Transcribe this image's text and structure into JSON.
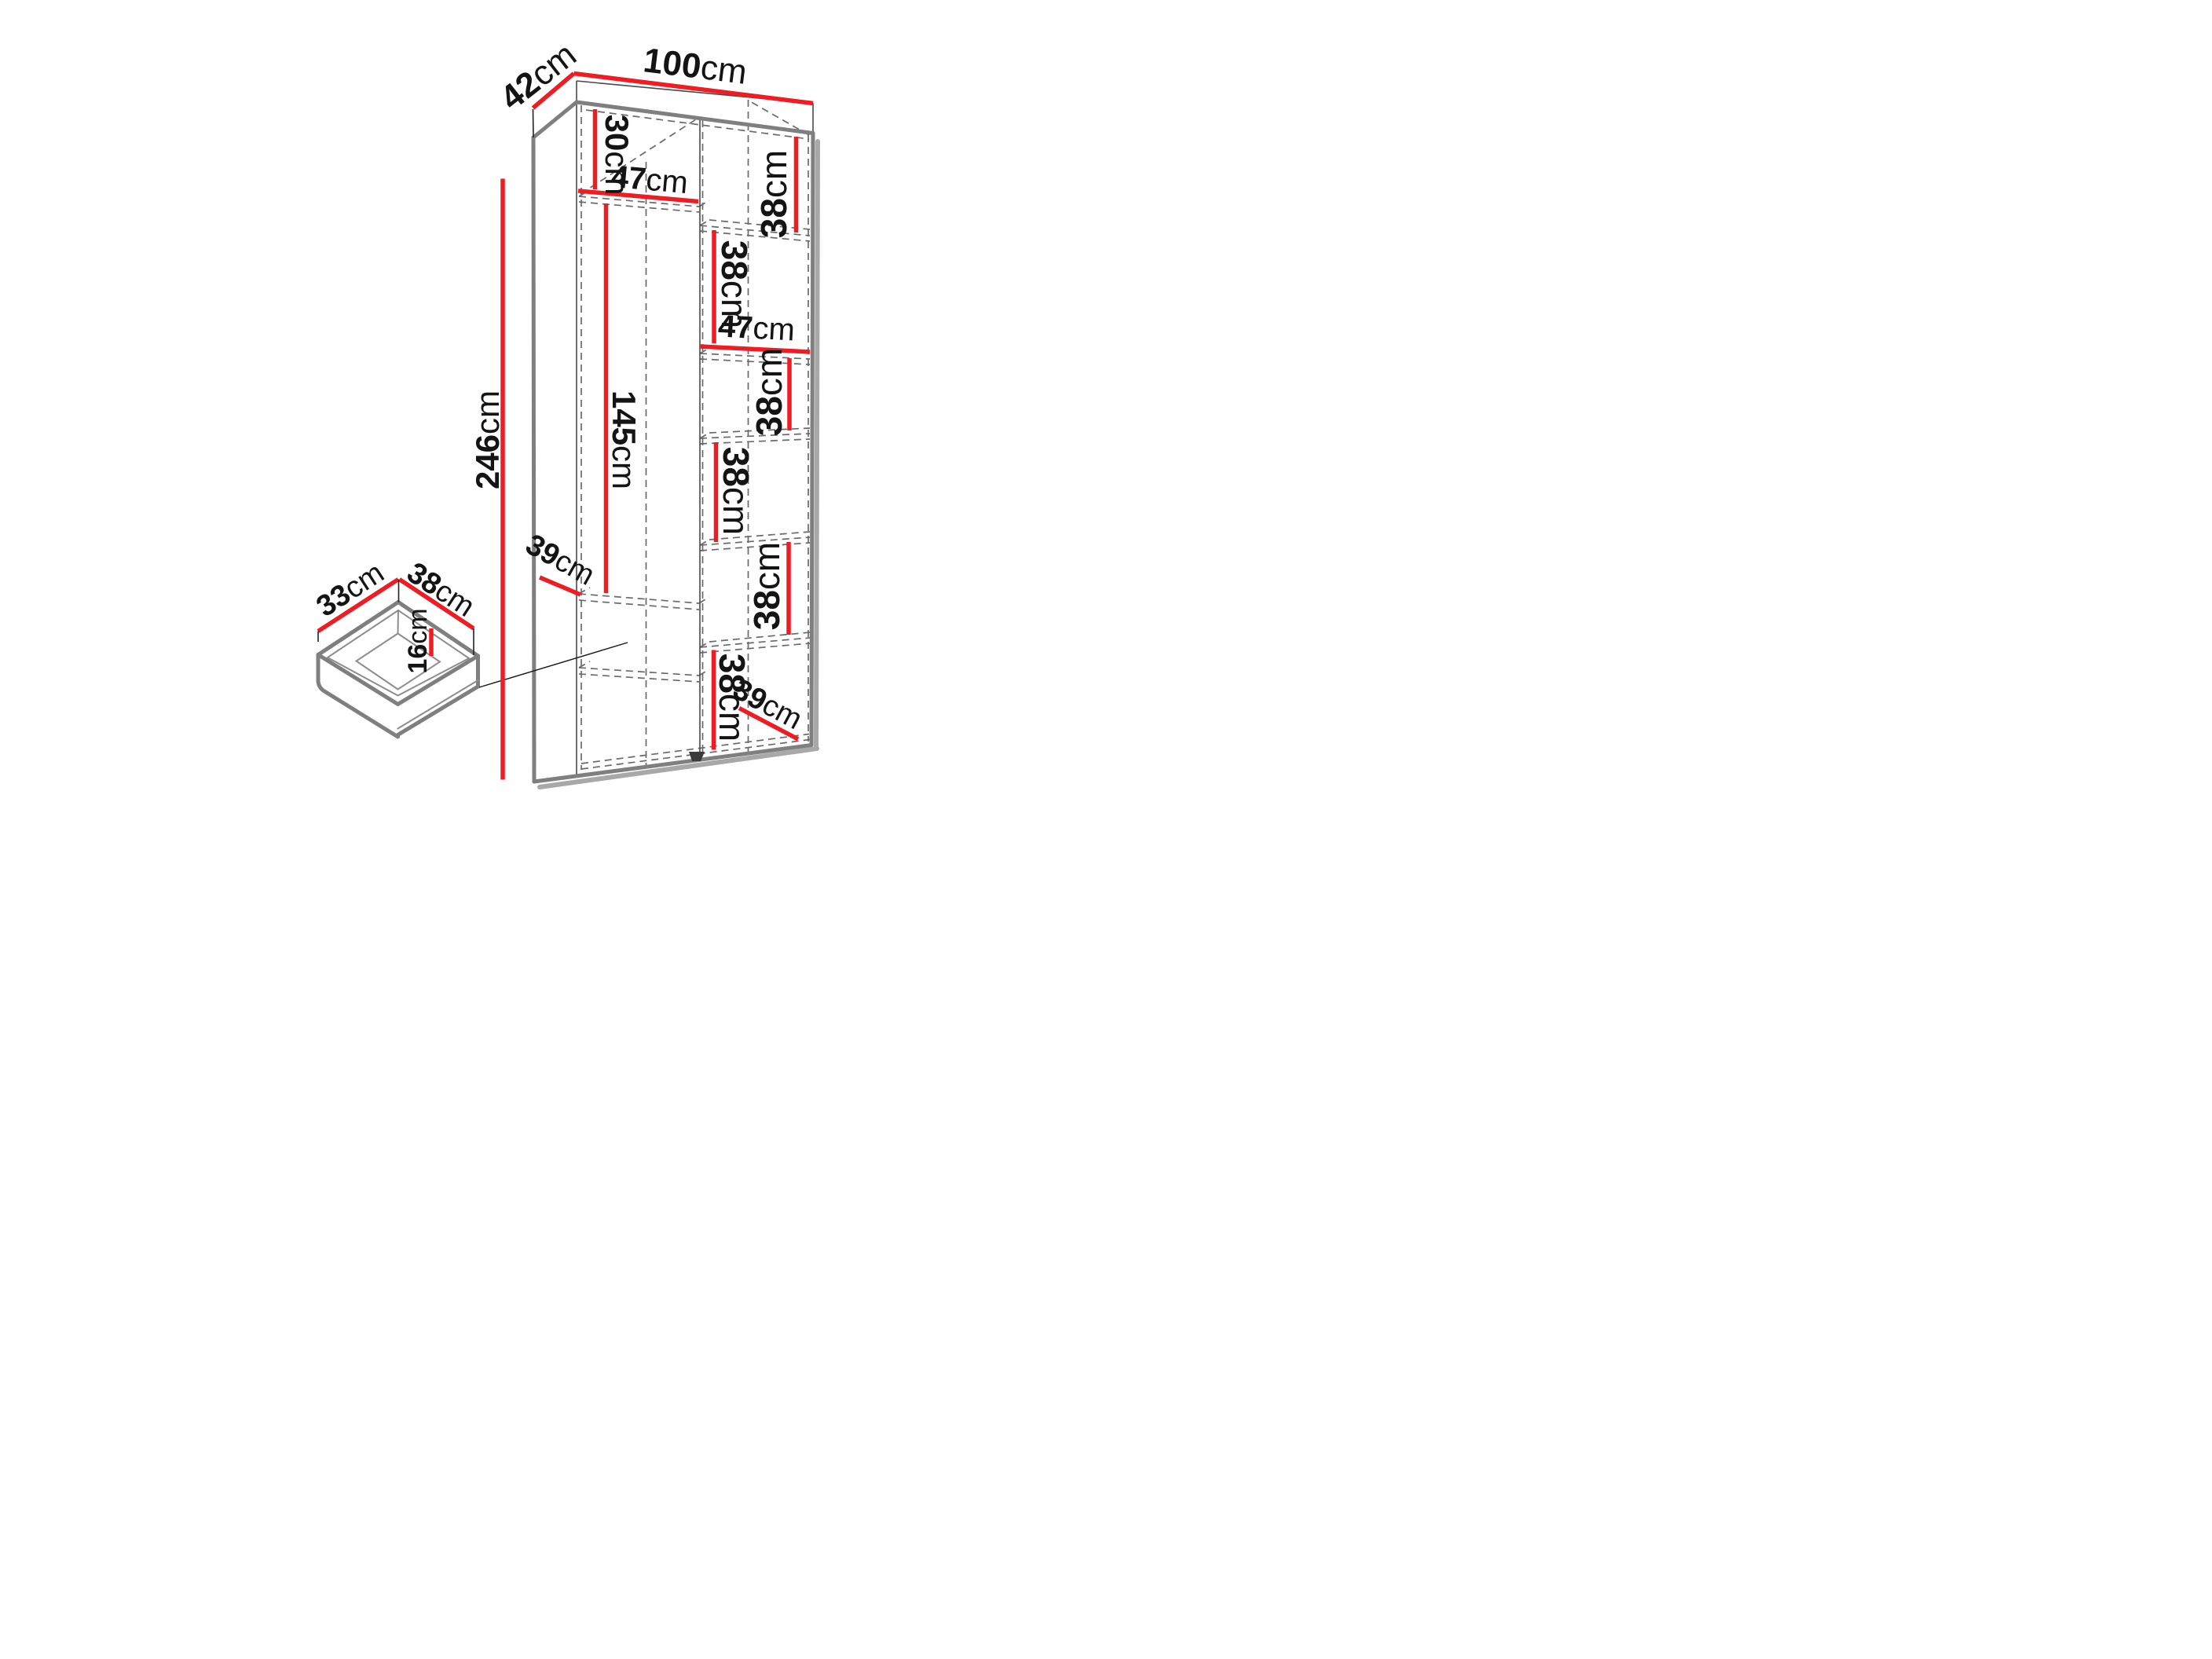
{
  "diagram_type": "furniture-dimension-diagram",
  "colors": {
    "dimension_red": "#ee1c23",
    "edge_gray": "#7f7f7f",
    "shadow_gray": "#a8a8a8",
    "hidden_line_gray": "#6a6a6a",
    "text_black": "#141414"
  },
  "labels": {
    "width": {
      "num": "100",
      "unit": "cm"
    },
    "depth": {
      "num": "42",
      "unit": "cm"
    },
    "height": {
      "num": "246",
      "unit": "cm"
    },
    "top_shelf": {
      "num": "30",
      "unit": "cm"
    },
    "shelf_width_left": {
      "num": "47",
      "unit": "cm"
    },
    "hanging_space": {
      "num": "145",
      "unit": "cm"
    },
    "shelf_depth_left": {
      "num": "39",
      "unit": "cm"
    },
    "shelf_width_right": {
      "num": "47",
      "unit": "cm"
    },
    "shelf_depth_right": {
      "num": "39",
      "unit": "cm"
    },
    "compartments": [
      {
        "num": "38",
        "unit": "cm"
      },
      {
        "num": "38",
        "unit": "cm"
      },
      {
        "num": "38",
        "unit": "cm"
      },
      {
        "num": "38",
        "unit": "cm"
      },
      {
        "num": "38",
        "unit": "cm"
      },
      {
        "num": "38",
        "unit": "cm"
      }
    ],
    "drawer_depth": {
      "num": "33",
      "unit": "cm"
    },
    "drawer_width": {
      "num": "38",
      "unit": "cm"
    },
    "drawer_height": {
      "num": "16",
      "unit": "cm"
    }
  }
}
